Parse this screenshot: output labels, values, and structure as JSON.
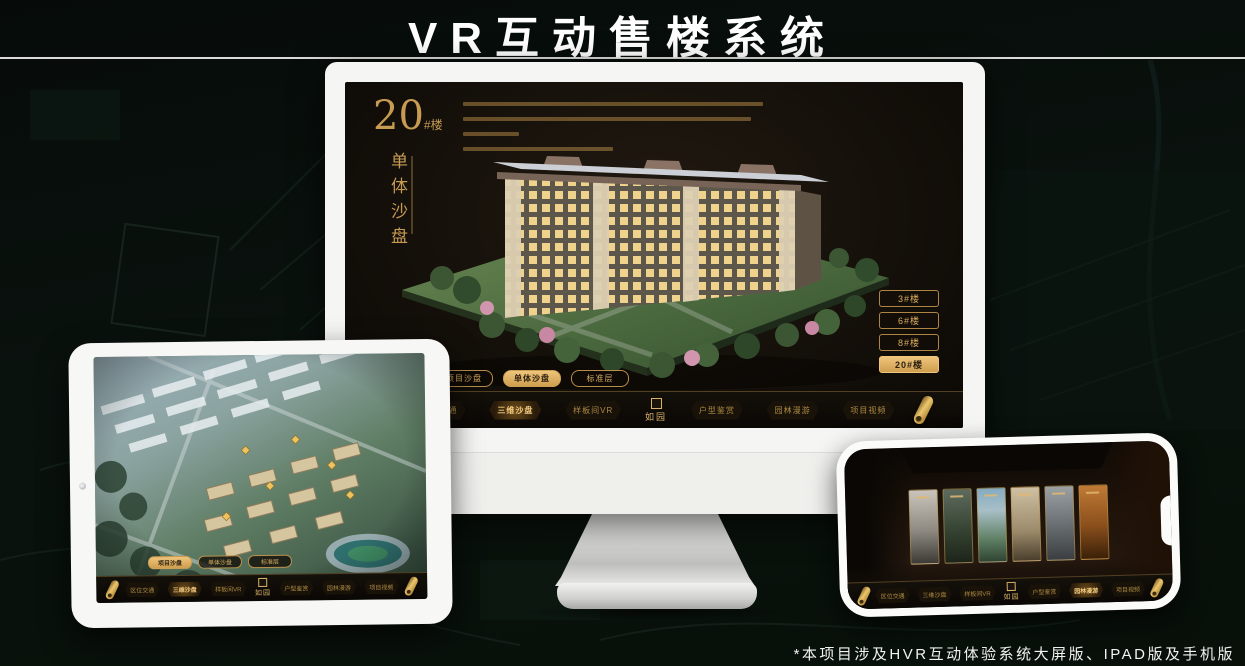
{
  "page": {
    "title": "VR互动售楼系统",
    "footnote": "*本项目涉及HVR互动体验系统大屏版、IPAD版及手机版"
  },
  "colors": {
    "gold": "#c79c52",
    "gold_bright": "#eec57c",
    "screen_bg": "#15100a",
    "page_bg": "#081009",
    "device_white": "#f5f5f3"
  },
  "icons": {
    "scroll_icon": "gold-rolled-scroll",
    "camera_icon": "front-camera-dot",
    "logo_seal_icon": "square-seal-stamp"
  },
  "nav": {
    "logo": "如园",
    "items": [
      {
        "label": "区位交通"
      },
      {
        "label": "三维沙盘"
      },
      {
        "label": "样板间VR"
      },
      {
        "label": "户型鉴赏"
      },
      {
        "label": "园林漫游"
      },
      {
        "label": "项目视频"
      }
    ]
  },
  "monitor": {
    "block_number": "20",
    "block_unit": "#楼",
    "block_subtitle": "单体沙盘",
    "active_nav": "三维沙盘",
    "view_tabs": [
      {
        "label": "项目沙盘",
        "active": false
      },
      {
        "label": "单体沙盘",
        "active": true
      },
      {
        "label": "标准层",
        "active": false
      }
    ],
    "floor_buttons": [
      {
        "label": "3#楼",
        "active": false
      },
      {
        "label": "6#楼",
        "active": false
      },
      {
        "label": "8#楼",
        "active": false
      },
      {
        "label": "20#楼",
        "active": true
      }
    ]
  },
  "ipad": {
    "active_nav": "三维沙盘",
    "view_tabs": [
      {
        "label": "项目沙盘",
        "active": true
      },
      {
        "label": "单体沙盘",
        "active": false
      },
      {
        "label": "标准层",
        "active": false
      }
    ]
  },
  "phone": {
    "active_nav": "园林漫游"
  }
}
